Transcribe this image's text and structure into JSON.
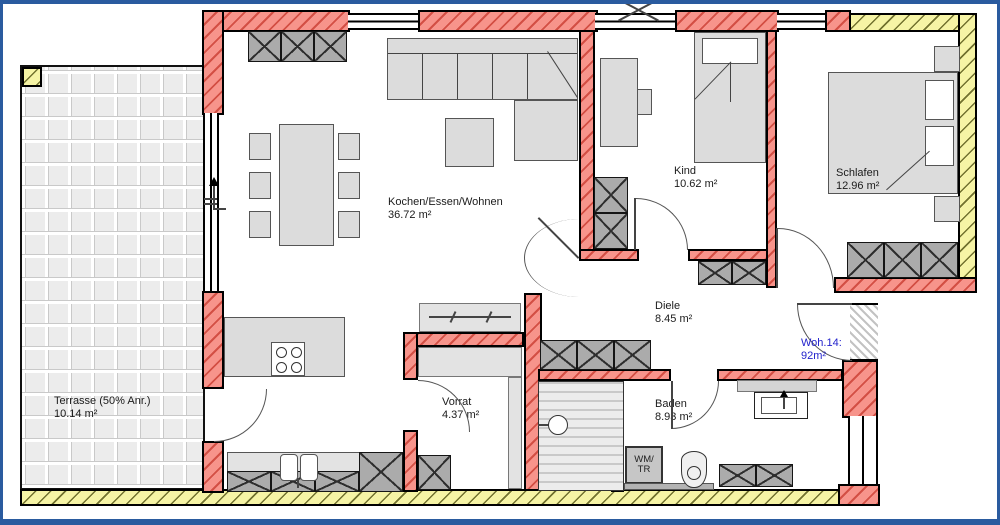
{
  "rooms": [
    {
      "name": "Terrasse (50% Anr.)",
      "area": "10.14 m²"
    },
    {
      "name": "Kochen/Essen/Wohnen",
      "area": "36.72 m²"
    },
    {
      "name": "Kind",
      "area": "10.62 m²"
    },
    {
      "name": "Schlafen",
      "area": "12.96 m²"
    },
    {
      "name": "Diele",
      "area": "8.45 m²"
    },
    {
      "name": "Vorrat",
      "area": "4.37 m²"
    },
    {
      "name": "Baden",
      "area": "8.93 m²"
    }
  ],
  "apartment": {
    "label": "Woh.14:",
    "area": "92m²"
  },
  "laundry": {
    "line1": "WM/",
    "line2": "TR"
  },
  "colors": {
    "frame_blue": "#2a5b9f",
    "wall_new_red": "#f7948b",
    "wall_existing_yellow": "#f6f4a5",
    "furniture_gray": "#dcdcdc",
    "cabinet_gray": "#ababab",
    "apartment_label_blue": "#2222cc"
  }
}
